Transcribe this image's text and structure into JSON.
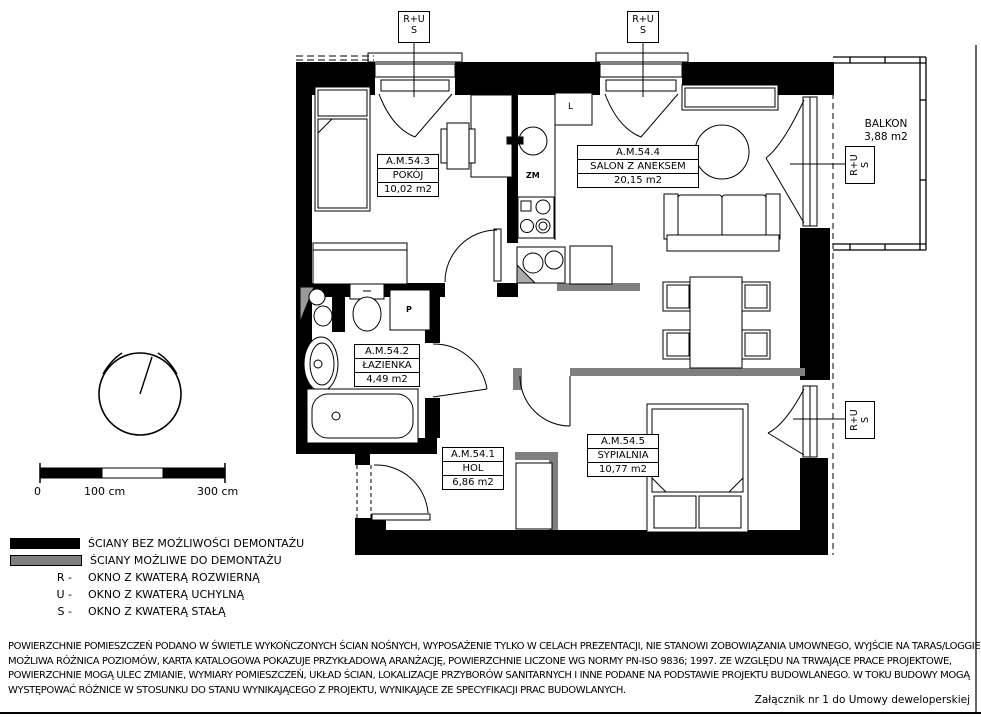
{
  "plan": {
    "rooms": [
      {
        "id": "A.M.54.1",
        "name": "HOL",
        "area": "6,86 m2"
      },
      {
        "id": "A.M.54.2",
        "name": "ŁAZIENKA",
        "area": "4,49 m2"
      },
      {
        "id": "A.M.54.3",
        "name": "POKÓJ",
        "area": "10,02 m2"
      },
      {
        "id": "A.M.54.4",
        "name": "SALON Z ANEKSEM",
        "area": "20,15 m2"
      },
      {
        "id": "A.M.54.5",
        "name": "SYPIALNIA",
        "area": "10,77 m2"
      }
    ],
    "balcony": {
      "name": "BALKON",
      "area": "3,88 m2"
    },
    "window_markers": {
      "line1": "R+U",
      "line2": "S"
    },
    "appliances": {
      "fridge": "L",
      "dishwasher": "ZM",
      "washer": "P"
    }
  },
  "scale_bar": {
    "tick0": "0",
    "tick100": "100 cm",
    "tick300": "300 cm"
  },
  "legend": {
    "wall_solid": "ŚCIANY BEZ MOŻLIWOŚCI DEMONTAŻU",
    "wall_demolishable": "ŚCIANY MOŻLIWE DO DEMONTAŻU",
    "windows": [
      {
        "key": "R -",
        "label": "OKNO Z KWATERĄ ROZWIERNĄ"
      },
      {
        "key": "U -",
        "label": "OKNO Z KWATERĄ UCHYLNĄ"
      },
      {
        "key": "S -",
        "label": "OKNO Z KWATERĄ STAŁĄ"
      }
    ]
  },
  "disclaimer": [
    "POWIERZCHNIE POMIESZCZEŃ PODANO W ŚWIETLE WYKOŃCZONYCH ŚCIAN NOŚNYCH, WYPOSAŻENIE TYLKO W CELACH PREZENTACJI, NIE STANOWI ZOBOWIĄZANIA UMOWNEGO, WYJŚCIE NA TARAS/LOGGIE-",
    "MOŻLIWA RÓŻNICA POZIOMÓW, KARTA KATALOGOWA POKAZUJE PRZYKŁADOWĄ ARANŻACJĘ, POWIERZCHNIE LICZONE WG NORMY PN-ISO 9836; 1997. ZE WZGLĘDU NA TRWAJĄCE PRACE PROJEKTOWE,",
    "POWIERZCHNIE MOGĄ ULEC ZMIANIE, WYMIARY POMIESZCZEŃ, UKŁAD ŚCIAN, LOKALIZACJE PRZYBORÓW SANITARNYCH I INNE PODANE NA PODSTAWIE PROJEKTU BUDOWLANEGO. W TOKU BUDOWY MOGĄ",
    "WYSTĘPOWAĆ RÓŻNICE W STOSUNKU DO STANU WYNIKAJĄCEGO Z PROJEKTU, WYNIKAJĄCE ZE SPECYFIKACJI PRAC BUDOWLANYCH."
  ],
  "attachment_note": "Załącznik nr 1 do Umowy deweloperskiej",
  "colors": {
    "wall": "#000000",
    "wall_demolishable": "#7f7f7f",
    "background": "#ffffff"
  }
}
